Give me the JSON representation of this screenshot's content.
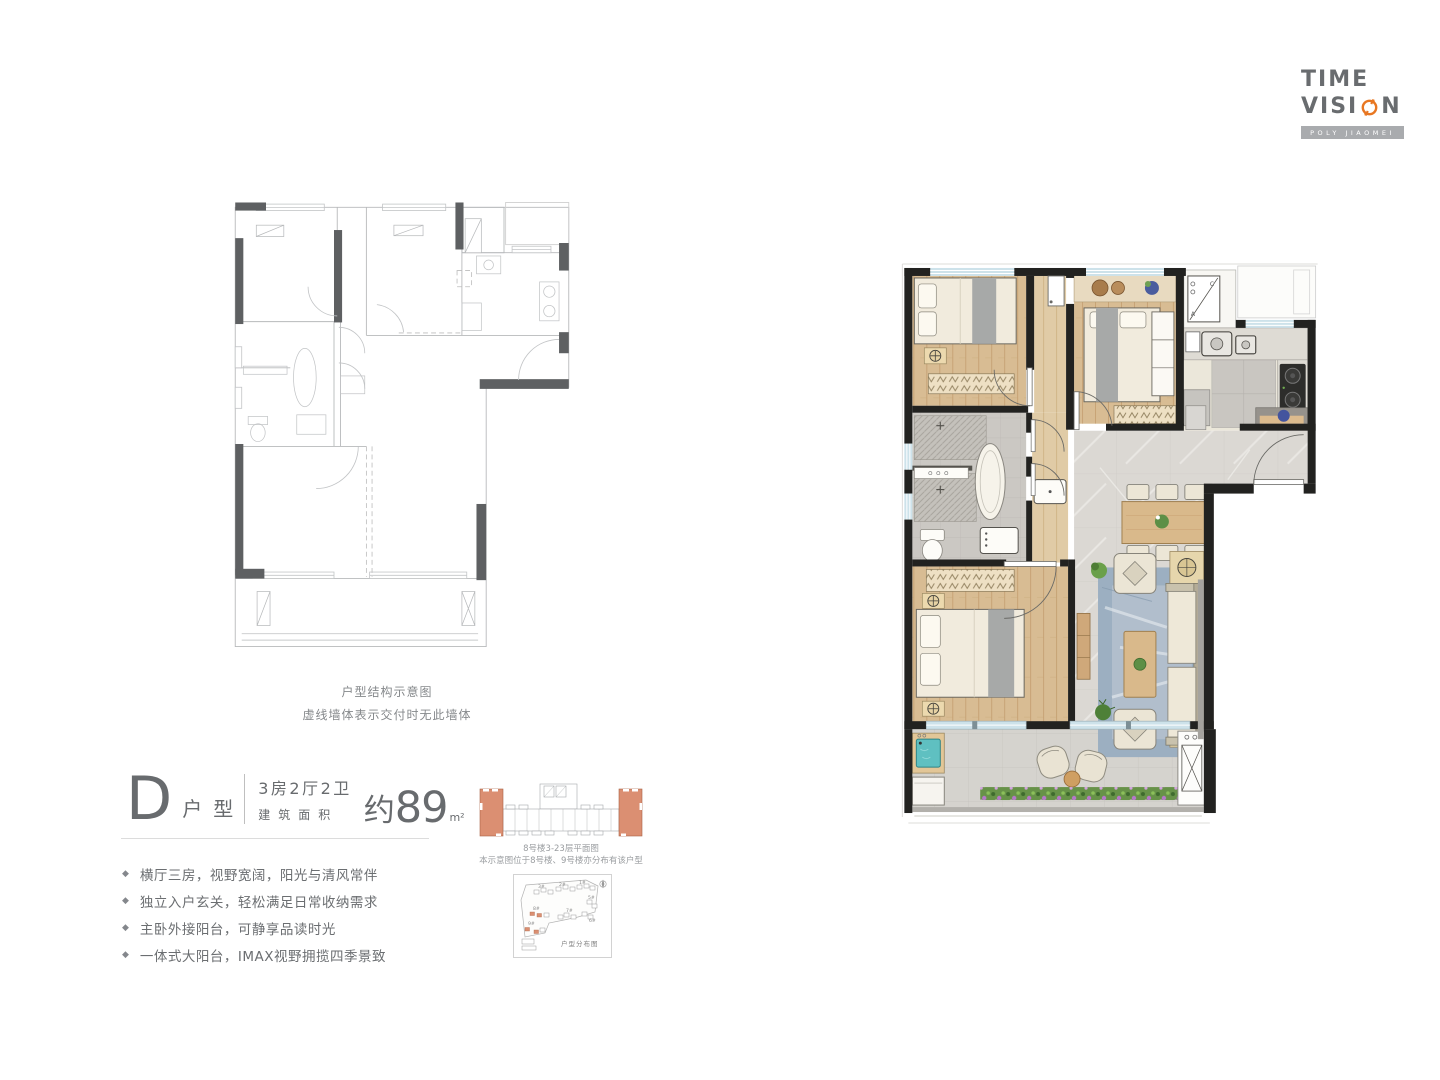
{
  "logo": {
    "line1": "TIME",
    "line2_pre": "VISI",
    "line2_post": "N",
    "tagline": "POLY JIAOMEI"
  },
  "structural_plan": {
    "caption_title": "户型结构示意图",
    "caption_note": "虚线墙体表示交付时无此墙体"
  },
  "unit": {
    "letter": "D",
    "type_label": "户型",
    "rooms": "3房2厅2卫",
    "area_label": "建筑面积",
    "area_approx": "约",
    "area_value": "89",
    "area_unit": "m²"
  },
  "features_bullet": "◆",
  "features": [
    "横厅三房，视野宽阔，阳光与清风常伴",
    "独立入户玄关，轻松满足日常收纳需求",
    "主卧外接阳台，可静享品读时光",
    "一体式大阳台，IMAX视野拥揽四季景致"
  ],
  "building_plan": {
    "caption_line1": "8号楼3-23层平面图",
    "caption_line2": "本示意图位于8号楼、9号楼亦分布有该户型"
  },
  "site_plan": {
    "label": "户型分布图",
    "buildings": [
      "1#",
      "2#",
      "3#",
      "5#",
      "6#",
      "7#",
      "8#",
      "9#"
    ]
  },
  "ac_label": {
    "a": "A",
    "c": "C"
  },
  "colors": {
    "accent_orange": "#e87722",
    "highlight_unit": "#db8f72",
    "wall_black": "#222220",
    "logo_gray": "#696c6f",
    "tagline_bar": "#a9abae"
  }
}
